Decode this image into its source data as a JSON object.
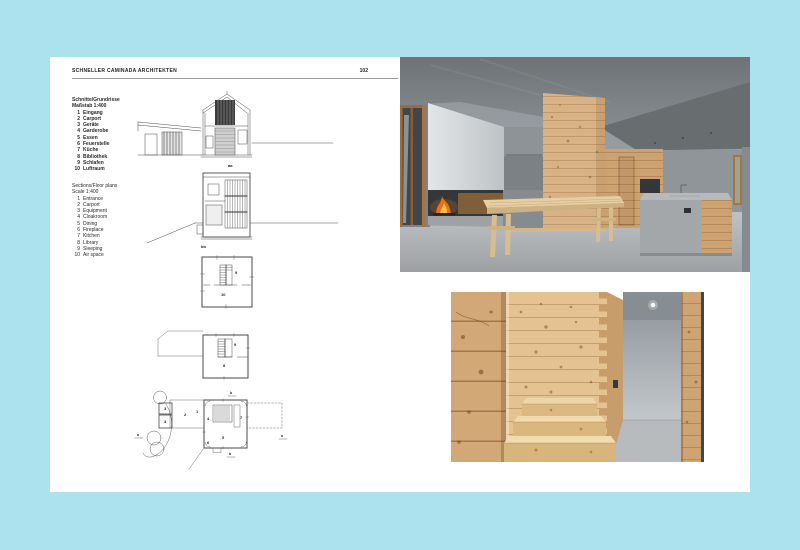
{
  "colors": {
    "bg": "#ace1ee",
    "page": "#ffffff",
    "ink": "#222222",
    "drawing-line": "#4a4a4a",
    "wood": "#d7b286",
    "wood-light": "#e4c291",
    "concrete-dark": "#6e7376",
    "concrete-light": "#b9bdbf",
    "fire": "#e87016"
  },
  "header": {
    "title": "SCHNELLER CAMINADA ARCHITEKTEN",
    "page_number": "102"
  },
  "legend_de": {
    "title": "Schnitte/Grundrisse",
    "scale": "Maßstab 1:400",
    "items": [
      {
        "num": "1",
        "label": "Eingang"
      },
      {
        "num": "2",
        "label": "Carport"
      },
      {
        "num": "3",
        "label": "Geräte"
      },
      {
        "num": "4",
        "label": "Garderobe"
      },
      {
        "num": "5",
        "label": "Essen"
      },
      {
        "num": "6",
        "label": "Feuerstelle"
      },
      {
        "num": "7",
        "label": "Küche"
      },
      {
        "num": "8",
        "label": "Bibliothek"
      },
      {
        "num": "9",
        "label": "Schlafen"
      },
      {
        "num": "10",
        "label": "Luftraum"
      }
    ]
  },
  "legend_en": {
    "title": "Sections/Floor plans",
    "scale": "Scale 1:400",
    "items": [
      {
        "num": "1",
        "label": "Entrance"
      },
      {
        "num": "2",
        "label": "Carport"
      },
      {
        "num": "3",
        "label": "Equipment"
      },
      {
        "num": "4",
        "label": "Cloakroom"
      },
      {
        "num": "5",
        "label": "Dining"
      },
      {
        "num": "6",
        "label": "Fireplace"
      },
      {
        "num": "7",
        "label": "Kitchen"
      },
      {
        "num": "8",
        "label": "Library"
      },
      {
        "num": "9",
        "label": "Sleeping"
      },
      {
        "num": "10",
        "label": "Air space"
      }
    ]
  },
  "drawings": {
    "section_aa": {
      "caption": "aa"
    },
    "section_bb": {
      "caption": "bb"
    },
    "plan_upper": {
      "room_9": "9",
      "room_10": "10"
    },
    "plan_middle": {
      "room_9": "9",
      "room_8": "8"
    },
    "plan_ground": {
      "room_1": "1",
      "room_2": "2",
      "room_3a": "3",
      "room_3b": "3",
      "room_4": "4",
      "room_5": "5",
      "room_6": "6",
      "room_7": "7",
      "marker_a_left": "a",
      "marker_a_right": "a",
      "marker_b_top": "b",
      "marker_b_bottom": "b"
    }
  }
}
